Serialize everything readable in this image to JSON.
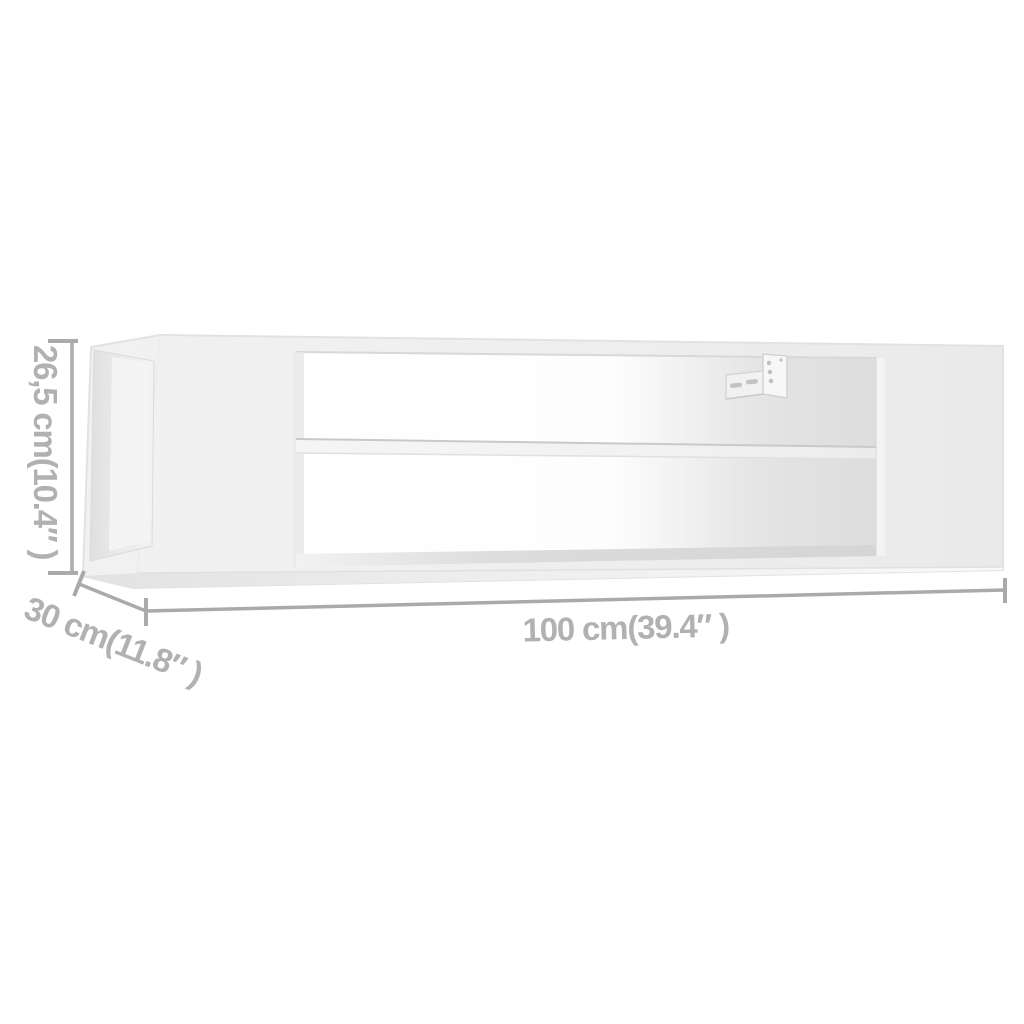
{
  "diagram": {
    "kind": "furniture-dimension-illustration",
    "subject": "wall-mounted hanging TV shelf, white, open two-tier middle section with wall bracket",
    "dimensions": {
      "height_label": "26,5 cm(10.4″ )",
      "depth_label": "30 cm(11.8″ )",
      "width_label": "100 cm(39.4″ )"
    },
    "colors": {
      "background": "#ffffff",
      "dimension_line": "#aaaaaa",
      "dimension_text": "#b1b1b1",
      "furniture_face": "#eeeeee",
      "furniture_edge": "#e2e2e2",
      "interior_shadow": "#dedede",
      "opening_light": "#ffffff",
      "bracket_metal": "#f5f5f5",
      "bracket_hole": "#bfbfbf"
    }
  }
}
